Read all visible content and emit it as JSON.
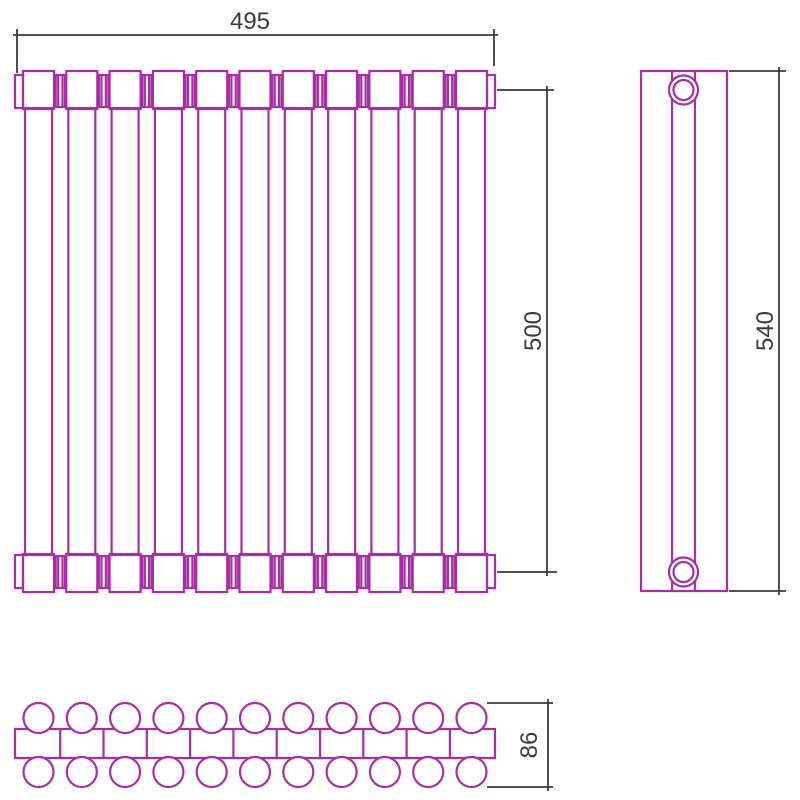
{
  "page": {
    "background": "#ffffff",
    "description": "Radiator technical drawing with three orthographic views"
  },
  "colors": {
    "outline": "#aa2da5",
    "dimension": "#3a3a3a"
  },
  "front_view": {
    "column_count": 11,
    "connector_count": 10
  },
  "side_view": {
    "port_count": 2
  },
  "bottom_view": {
    "tube_count_per_row": 11,
    "rows": 2,
    "divider_count": 10
  },
  "dimensions": {
    "width": "495",
    "height": "500",
    "side_height": "540",
    "depth": "86"
  }
}
